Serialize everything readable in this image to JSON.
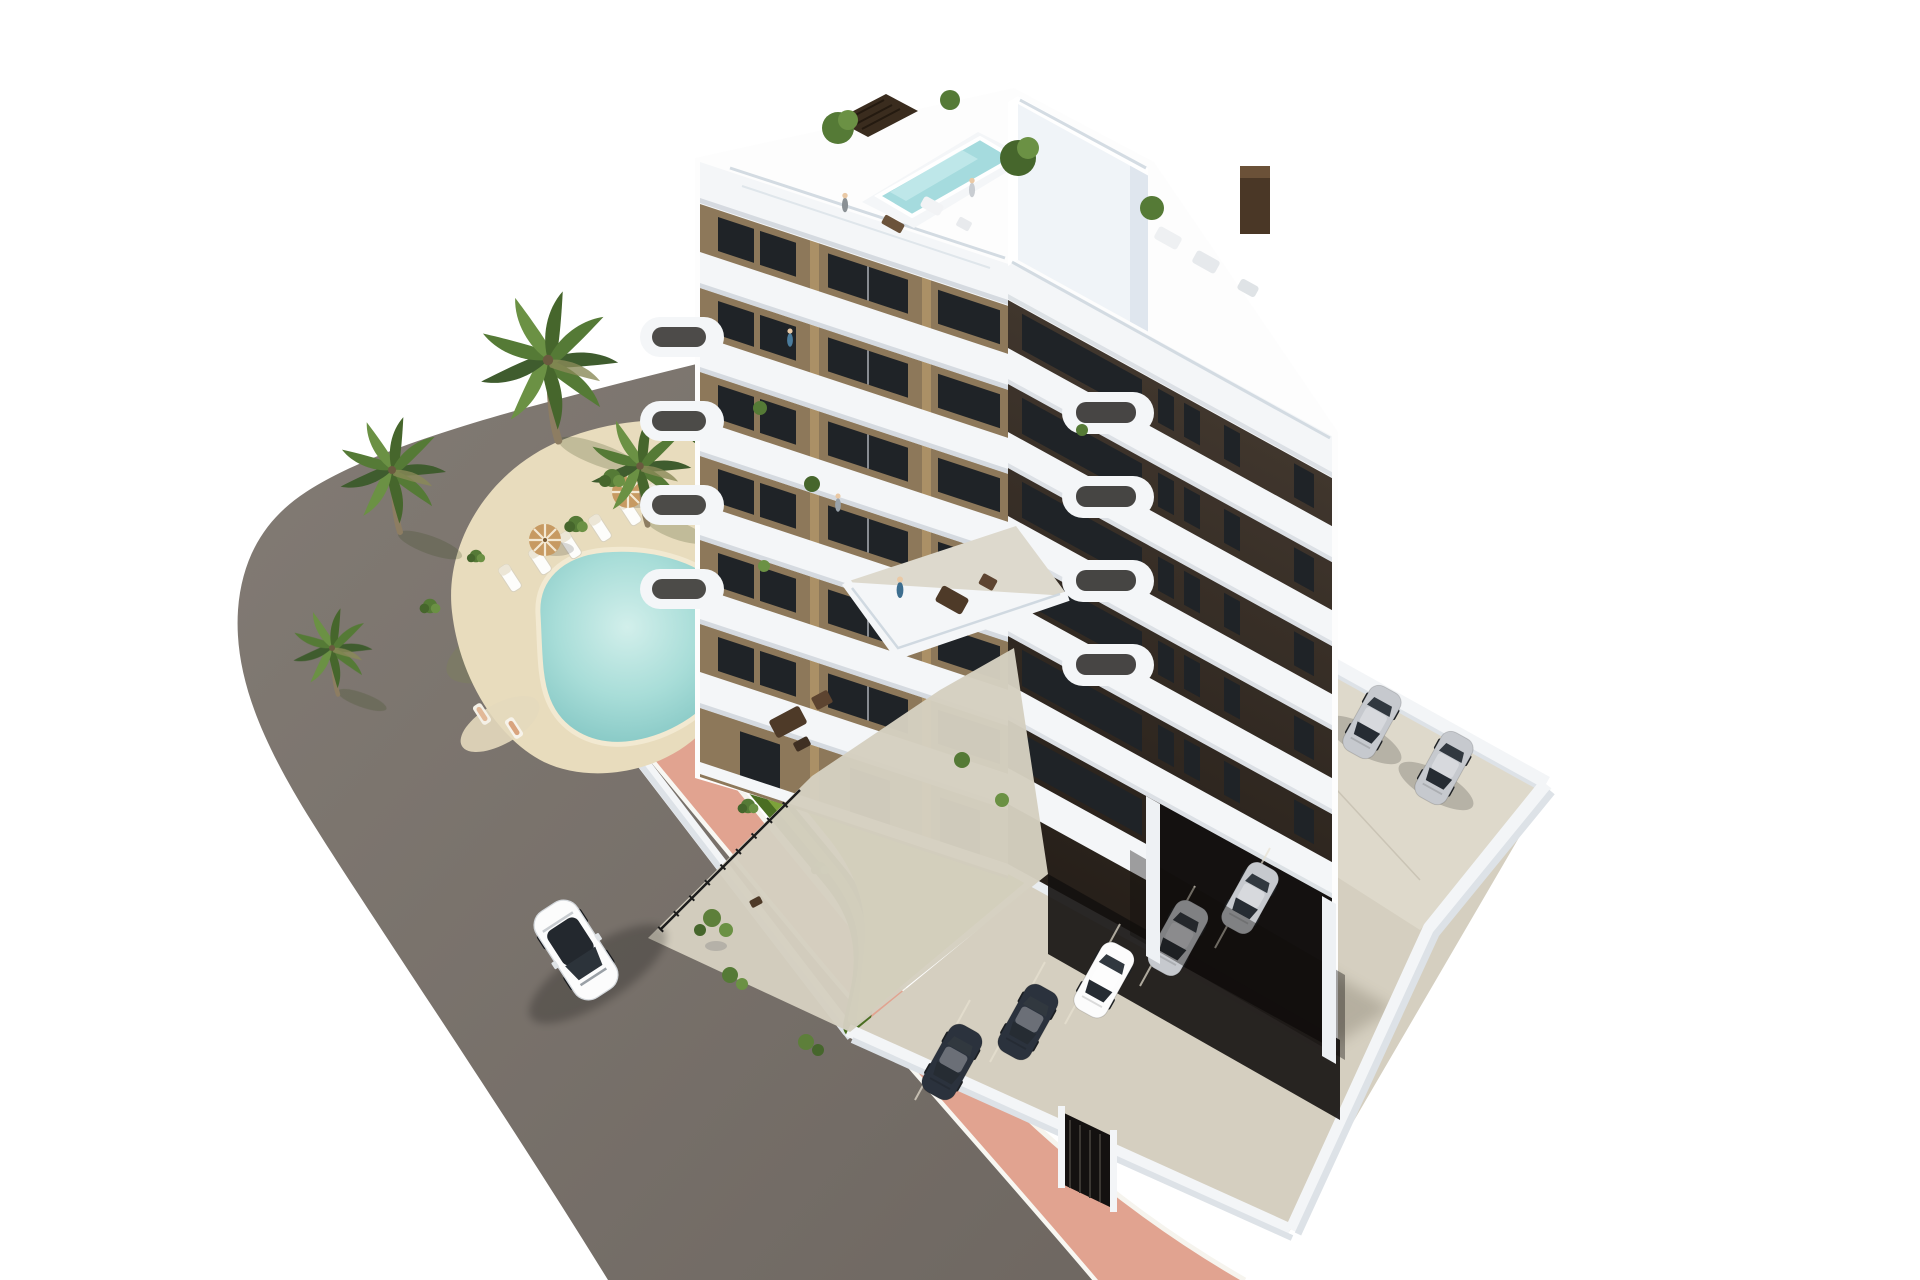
{
  "image": {
    "type": "architectural-3d-rendering",
    "width": 1920,
    "height": 1280,
    "description": "Aerial 3D rendering of a modern 7-storey apartment building with a light tan front facade, dark brown side facade, white wrap-around balcony bands and curved balcony parapets. The rooftop has a small aqua plunge pool, pergola, potted trees and lounge furniture. A landscaped garden with a free-form turquoise swimming pool, sandy pool deck, six sun loungers, two parasols, lawn, gravel beds, hedges and palm trees sits beside the building. A salmon-pink sidewalk and a gray asphalt road with one white car curve around the plot. Parking areas with silver and dark cars sit beside and beneath the building behind white perimeter walls."
  },
  "colors": {
    "background": "#ffffff",
    "road": "#78716b",
    "curb": "#f8f7f2",
    "sidewalk": "#e1a390",
    "sidewalkHighlight": "#eebfae",
    "gravel": "#d4d1c9",
    "stone": "#b5b1a8",
    "hedge": "#4a6e22",
    "hedgeHighlight": "#7da23a",
    "lawn": "#a6c04c",
    "lawnHighlight": "#c0d45c",
    "lawnShade": "#7e9c34",
    "poolDeck": "#e8dcbd",
    "poolWater": "#8fd0cd",
    "poolWaterLight": "#d2efeb",
    "poolRim": "#f2e9d1",
    "palmTrunk": "#8d7d62",
    "palmFrondDark": "#3f5c2e",
    "palmFrond": "#557a36",
    "palmFrondLight": "#6b9144",
    "buildingWhite": "#f4f6f8",
    "buildingShadeLight": "#e3e9ef",
    "buildingBase": "#fdfdfd",
    "facadeTan": "#8d785a",
    "facadeTanLight": "#b09468",
    "facadeDark": "#38302a",
    "windowGlass": "#1f2327",
    "garageDark": "#141110",
    "balustrade": "#ccd6de",
    "concrete": "#d5cfc0",
    "concreteLight": "#e6e1d4",
    "wallWhite": "#f3f5f7",
    "wallShade": "#dde2e7",
    "roofPool": "#a5dbde",
    "pergola": "#3a2c1e",
    "chimney": "#4a3726",
    "umbrella": "#c79a62",
    "carWhite": "#fcfcfc",
    "carSilver": "#c6c9ce",
    "carNavy": "#2b323d",
    "skin": "#eac9a5"
  },
  "scene": {
    "building": {
      "storeys_visible": 7,
      "front_facade": "light tan brown with white balcony bands",
      "side_facade": "dark brown with black window slits",
      "balcony_style": "white rounded / curved parapets",
      "rooftop": {
        "plunge_pool": true,
        "pergola": true,
        "potted_trees": 3,
        "chimney_box": true,
        "people": 2
      }
    },
    "garden": {
      "swimming_pool_shape": "free-form turquoise",
      "sun_loungers": 6,
      "parasols": 2,
      "sunbathers": 2,
      "palm_trees": 7,
      "hedge_border": true,
      "lawn": true,
      "gravel_beds": true
    },
    "street": {
      "road_surface": "gray asphalt",
      "sidewalk_color": "salmon pink with white curbs",
      "moving_cars": 1
    },
    "parking": {
      "open_air_cars": 2,
      "cars_under_building": 5,
      "entrance_gate": true,
      "white_perimeter_walls": true
    },
    "ground_terraces": {
      "lounge_furniture_sets": 2,
      "potted_plants": true,
      "metal_fence": true
    },
    "people_total": 9,
    "cars_total": 8
  }
}
